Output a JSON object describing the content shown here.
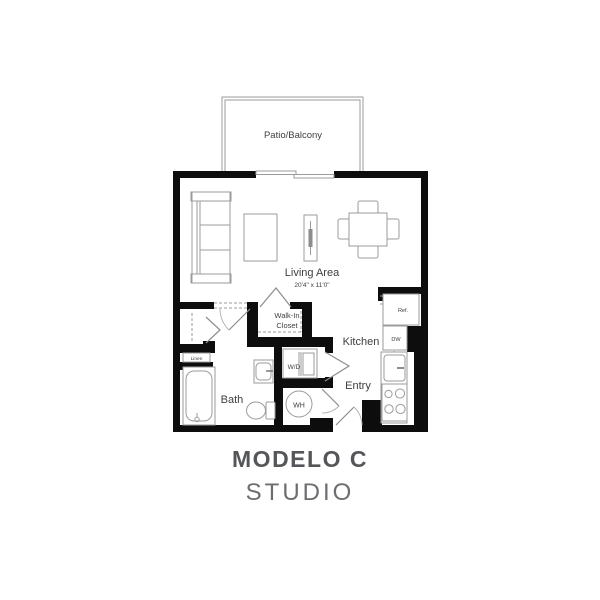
{
  "title": {
    "model_name": "MODELO C",
    "unit_type": "STUDIO"
  },
  "rooms": {
    "patio": {
      "label": "Patio/Balcony"
    },
    "living_area": {
      "label": "Living Area",
      "dimensions": "20'4\" x 11'0\""
    },
    "walk_in_closet": {
      "line1": "Walk-In",
      "line2": "Closet"
    },
    "kitchen": {
      "label": "Kitchen"
    },
    "entry": {
      "label": "Entry"
    },
    "bath": {
      "label": "Bath"
    },
    "linen": {
      "label": "Linen"
    }
  },
  "fixtures": {
    "washer_dryer": "W/D",
    "water_heater": "WH",
    "refrigerator": "Ref.",
    "dishwasher": "DW"
  },
  "colors": {
    "wall": "#0d0d0d",
    "furniture_line": "#9b9b9b",
    "label": "#3e3e3e",
    "title": "#55565a",
    "subtitle": "#6c6d70",
    "background": "#ffffff"
  }
}
